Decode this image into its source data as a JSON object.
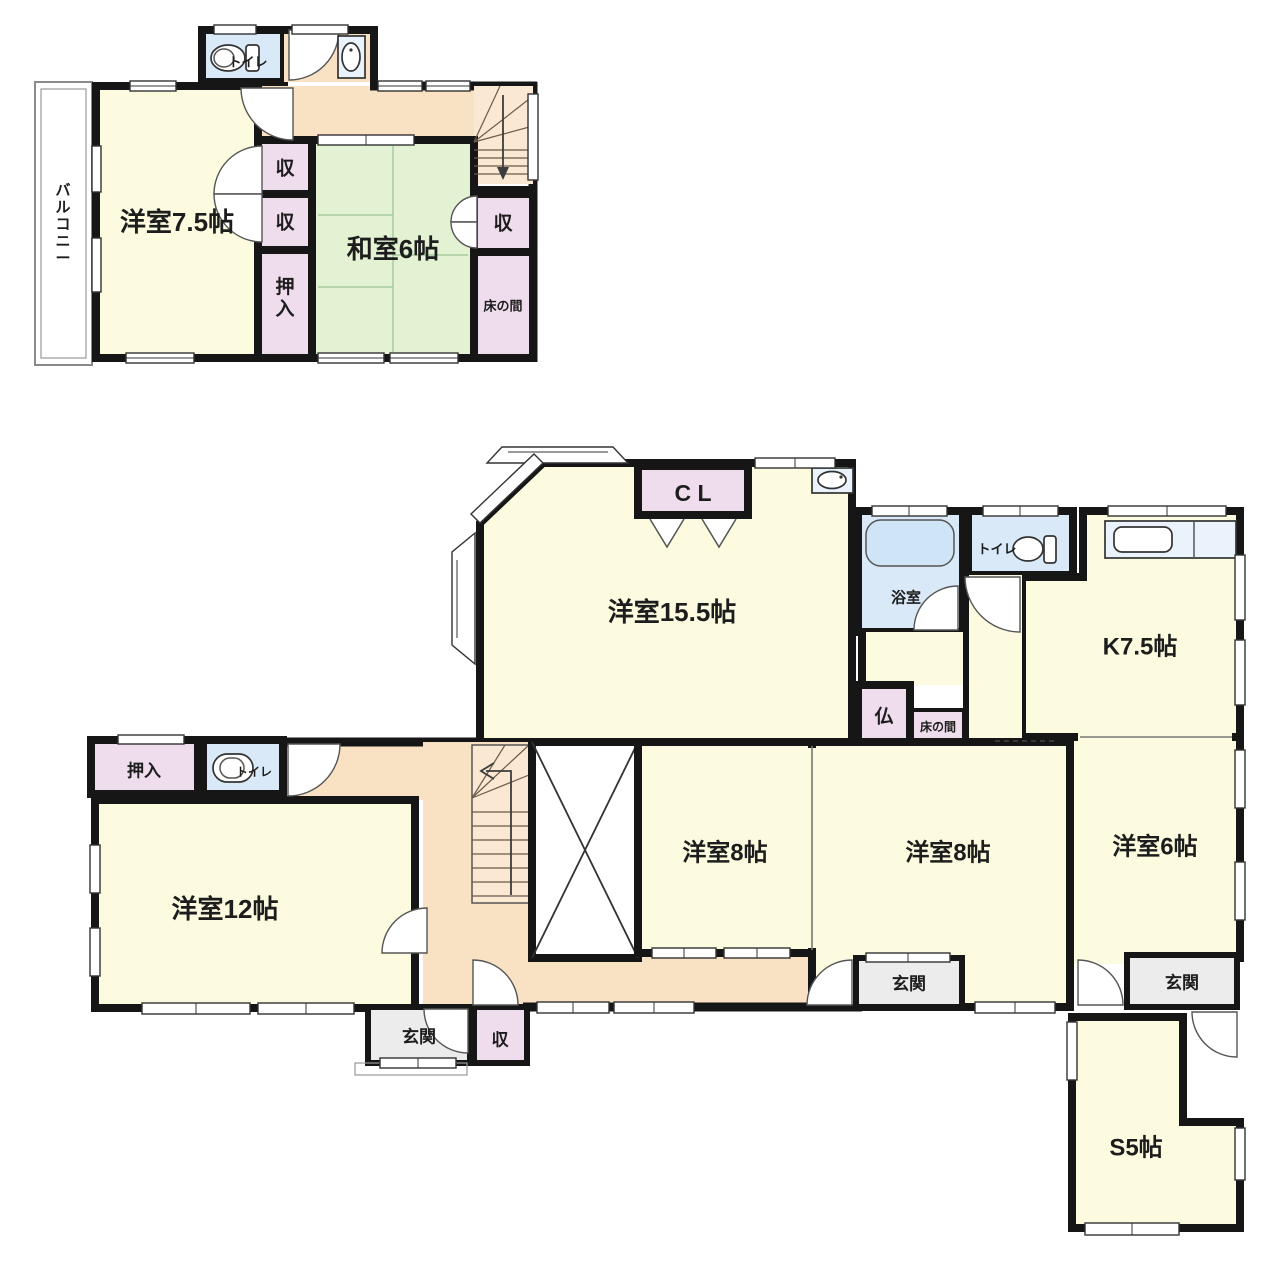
{
  "palette": {
    "wall": "#161616",
    "room_yellow": "#FCFADF",
    "tatami_green": "#E2F2D3",
    "storage_pink": "#EFDCEC",
    "hall_orange": "#F9E2C4",
    "water_blue": "#D9E9F8",
    "fixture_blue": "#CFE4F7",
    "genkan_gray": "#ECECEC"
  },
  "floor2": {
    "labels": {
      "room75": "洋室7.5帖",
      "washitsu6": "和室6帖",
      "balcony": "バルコニー",
      "storage": "収",
      "oshiire": "押入",
      "tokonoma": "床の間",
      "toilet": "トイレ"
    }
  },
  "floor1": {
    "labels": {
      "room155": "洋室15.5帖",
      "closet": "C L",
      "bath": "浴室",
      "toilet": "トイレ",
      "kitchen": "K7.5帖",
      "butsudan": "仏",
      "tokonoma": "床の間",
      "room8": "洋室8帖",
      "room6": "洋室6帖",
      "room12": "洋室12帖",
      "oshiire": "押入",
      "genkan": "玄関",
      "storage": "収",
      "service5": "S5帖"
    }
  }
}
